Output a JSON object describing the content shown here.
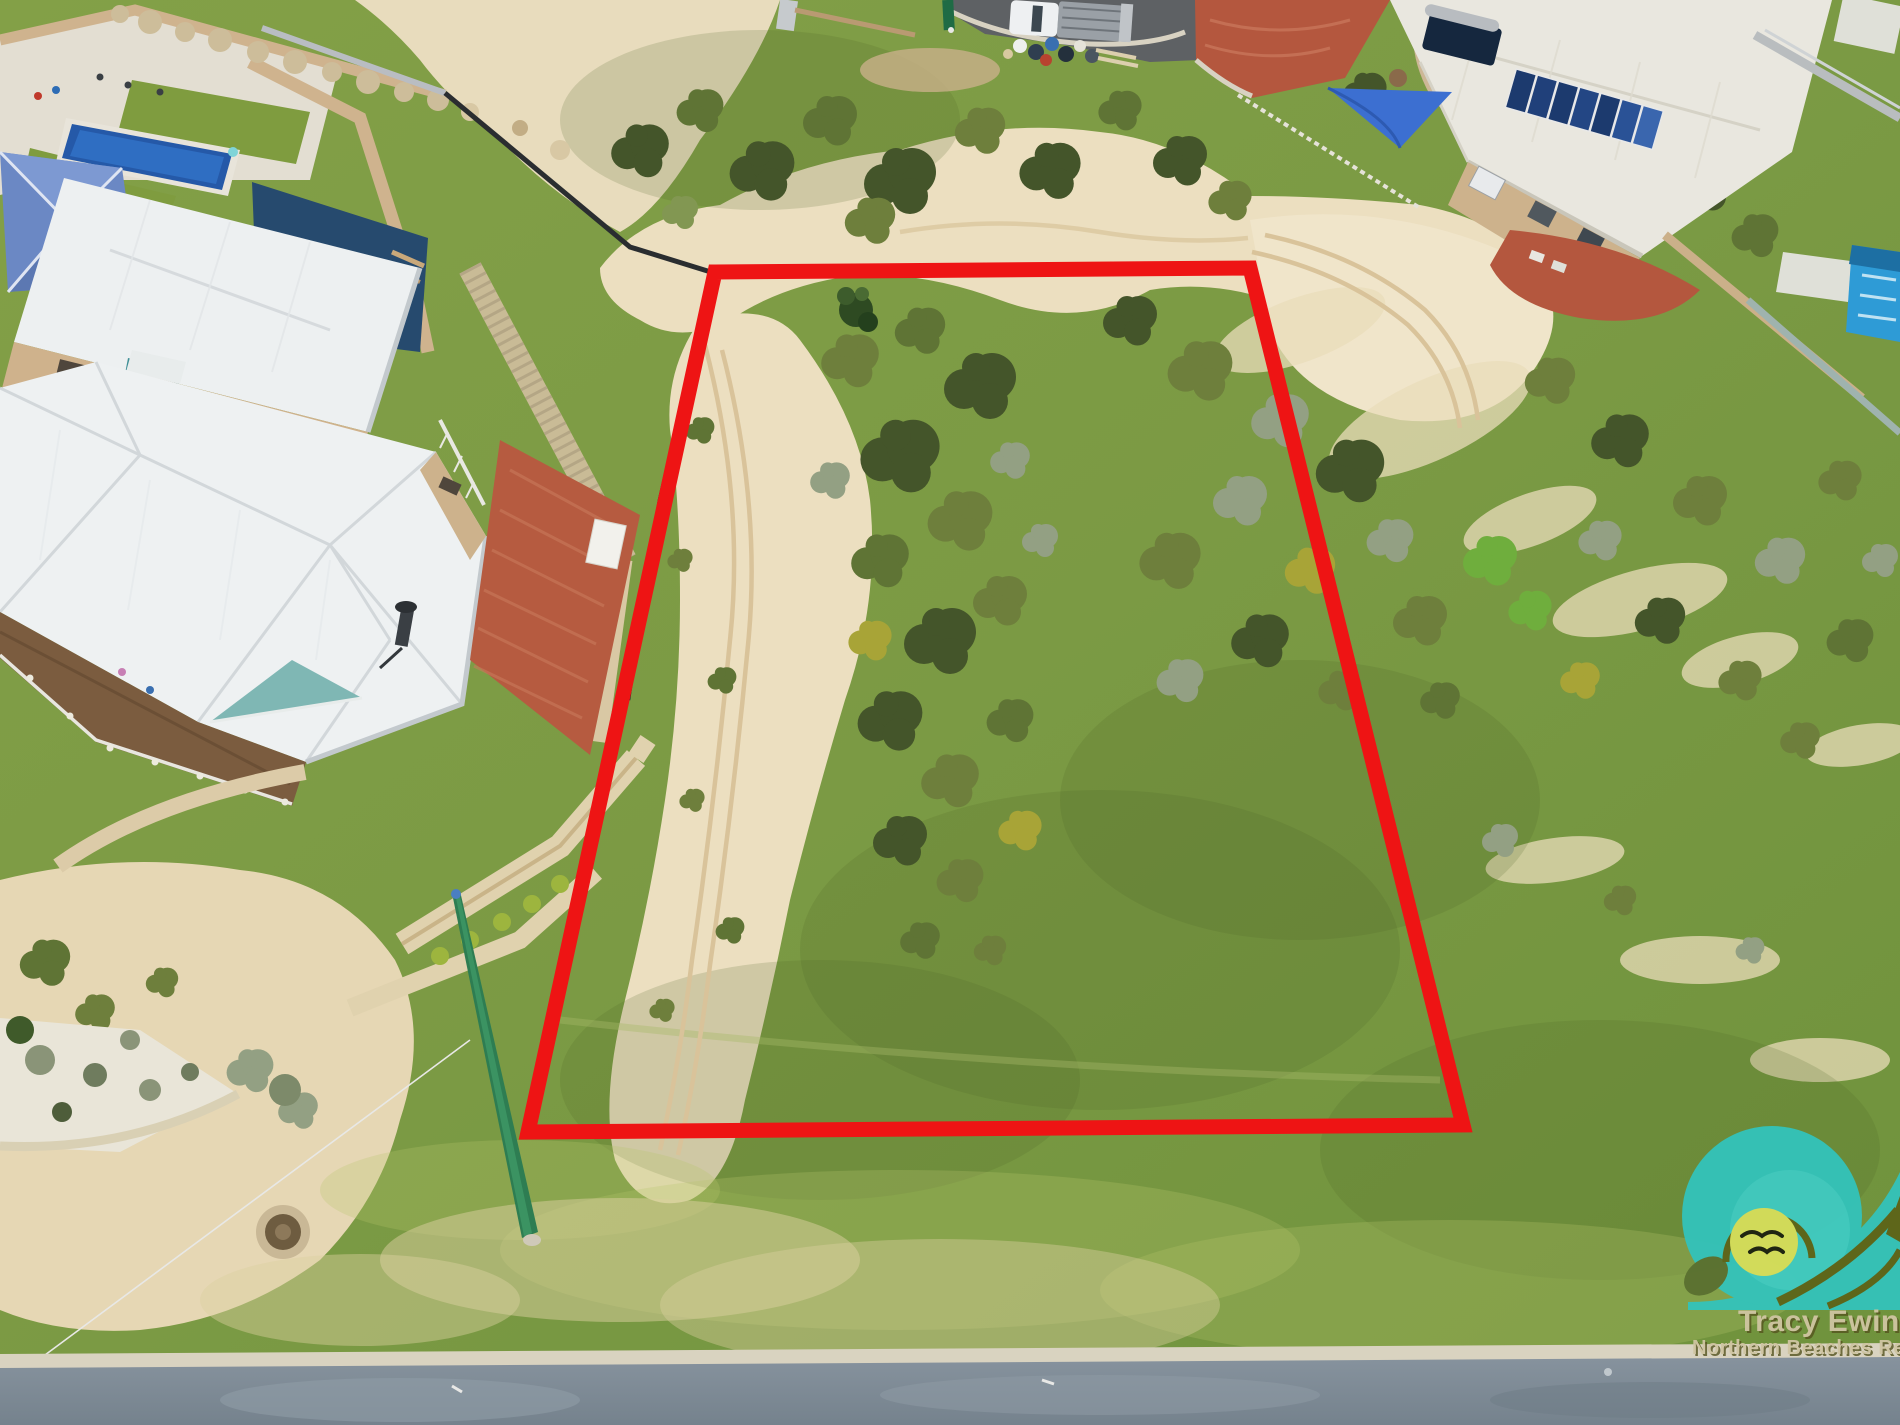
{
  "photo": {
    "description": "Aerial drone photo of a vacant beachside residential lot outlined in red, neighbouring houses to the left, coastal scrub dunes to the right, street at bottom",
    "lot_boundary": {
      "points": "715,272 1250,268 1463,1125 528,1132",
      "color": "#ee1414",
      "stroke_width": "15"
    },
    "watermark": {
      "agent_name": "Tracy Ewins",
      "agency_line": "Northern Beaches Re",
      "wave_color": "#33c3bb",
      "sun_color": "#d7df5b",
      "bird_color": "#1c200f",
      "text_color": "#cfc5a2",
      "shadow_color": "#55541f"
    },
    "palette": {
      "grass": "#7b9a44",
      "sand": "#ecdfc0",
      "road": "#7e8b96",
      "kerb": "#d9d3c0",
      "roof_white": "#eef1f2",
      "roof_cream": "#e9e7df",
      "pool_blue": "#2559a8",
      "brick": "#b65b40",
      "boundary_red": "#ee1414"
    }
  }
}
